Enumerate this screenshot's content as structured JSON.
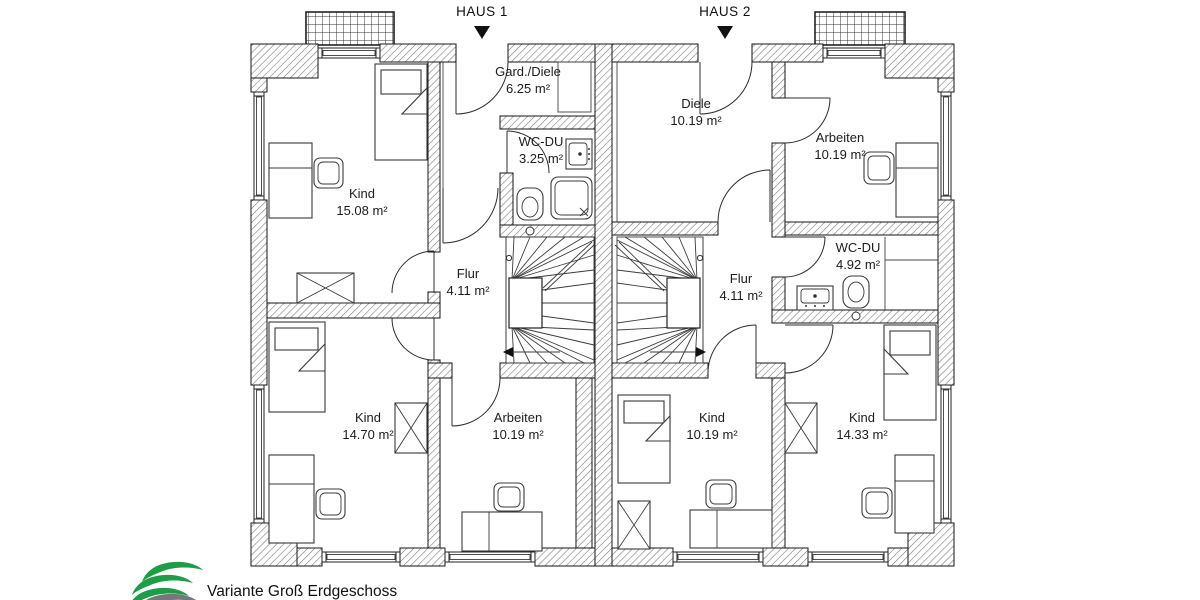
{
  "header": {
    "haus1_label": "HAUS 1",
    "haus2_label": "HAUS 2"
  },
  "rooms": [
    {
      "name": "Kind",
      "area": "15.08 m²"
    },
    {
      "name": "Gard./Diele",
      "area": "6.25 m²"
    },
    {
      "name": "WC-DU",
      "area": "3.25 m²"
    },
    {
      "name": "Flur",
      "area": "4.11 m²"
    },
    {
      "name": "Kind",
      "area": "14.70 m²"
    },
    {
      "name": "Arbeiten",
      "area": "10.19 m²"
    },
    {
      "name": "Diele",
      "area": "10.19 m²"
    },
    {
      "name": "Arbeiten",
      "area": "10.19 m²"
    },
    {
      "name": "WC-DU",
      "area": "4.92 m²"
    },
    {
      "name": "Flur",
      "area": "4.11 m²"
    },
    {
      "name": "Kind",
      "area": "10.19 m²"
    },
    {
      "name": "Kind",
      "area": "14.33 m²"
    }
  ],
  "footer": {
    "caption": "Variante Groß Erdgeschoss"
  },
  "colors": {
    "wall_line": "#161616",
    "hatch": "#777777",
    "text": "#1c1c1c",
    "logo_green": "#1e9c46",
    "logo_gray": "#75787b"
  }
}
